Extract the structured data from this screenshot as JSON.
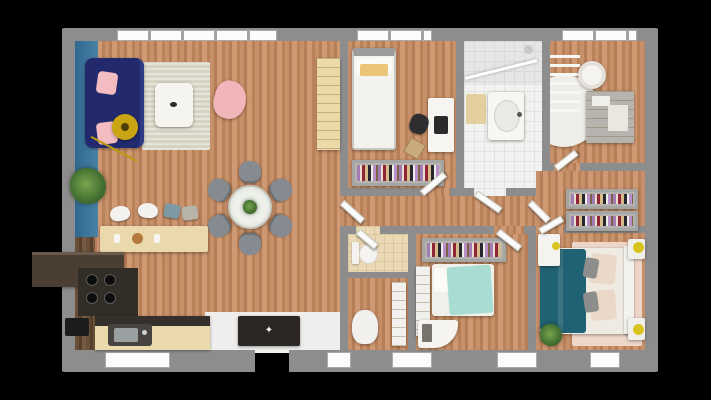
{
  "scene": {
    "description": "3D rendered top-down floor plan of a single-storey house on a black background",
    "bench_star_glyph": "✦"
  },
  "palette": {
    "background": "#000000",
    "walls": "#8d8d8d",
    "wood_floor": "#c08a63",
    "accent_wall_blue": "#2f6890",
    "sofa_navy": "#222a6d",
    "cushion_pink": "#f3bcc0",
    "armchair_pink": "#f0b6ba",
    "lamp_yellow": "#c9a513",
    "dining_chair_gray": "#868b92",
    "kitchen_cabinet_cream": "#ead9ab",
    "counter_dark": "#35302b",
    "hood_brown": "#4b3e33",
    "bench_dark": "#2c2724",
    "bed_white": "#f4f2ee",
    "pillow_yellow": "#ebc678",
    "blanket_mint": "#a9dcd2",
    "blanket_teal": "#206273",
    "rug_pink": "#eed6c9",
    "tile_white": "#f2f2f0",
    "tile_beige": "#ead9b4",
    "plant_green": "#4e7d3a"
  },
  "rooms": [
    {
      "id": "living-room",
      "furniture": [
        "navy-sofa",
        "pink-cushions",
        "area-rug",
        "coffee-table",
        "pink-armchair",
        "arc-floor-lamp",
        "potted-plant",
        "storage-cabinet"
      ]
    },
    {
      "id": "dining-area",
      "furniture": [
        "round-glass-table",
        "dining-chairs-x6",
        "table-plant"
      ]
    },
    {
      "id": "kitchen",
      "furniture": [
        "bar-counter",
        "bar-stools",
        "range-hood",
        "cooktop",
        "sink-counter",
        "dark-appliance"
      ]
    },
    {
      "id": "entrance",
      "furniture": [
        "bench-with-star",
        "white-floor"
      ]
    },
    {
      "id": "bedroom-1",
      "furniture": [
        "single-bed-white",
        "yellow-pillow",
        "desk",
        "desk-chair",
        "clothes-rack"
      ]
    },
    {
      "id": "bathroom",
      "furniture": [
        "walk-in-shower",
        "vanity-sink",
        "bath-mat"
      ]
    },
    {
      "id": "nursery-office",
      "furniture": [
        "round-rug",
        "swivel-pouf",
        "gray-dresser",
        "towel-ladder"
      ]
    },
    {
      "id": "dressing",
      "furniture": [
        "clothes-rack-upper",
        "clothes-rack-lower",
        "vanity-desk"
      ]
    },
    {
      "id": "wc",
      "furniture": [
        "toilet"
      ]
    },
    {
      "id": "utility",
      "furniture": [
        "laundry-basket",
        "storage-column"
      ]
    },
    {
      "id": "bedroom-2",
      "furniture": [
        "single-bed-mint",
        "clothes-rack",
        "white-desk",
        "wardrobe-column"
      ]
    },
    {
      "id": "master-bedroom",
      "furniture": [
        "double-bed-teal",
        "nightstand-x2",
        "yellow-lamp-x2",
        "pink-rug",
        "potted-plant"
      ]
    }
  ],
  "openings": {
    "windows_top": 3,
    "windows_bottom": 6,
    "entrance_door": "bottom-center"
  }
}
